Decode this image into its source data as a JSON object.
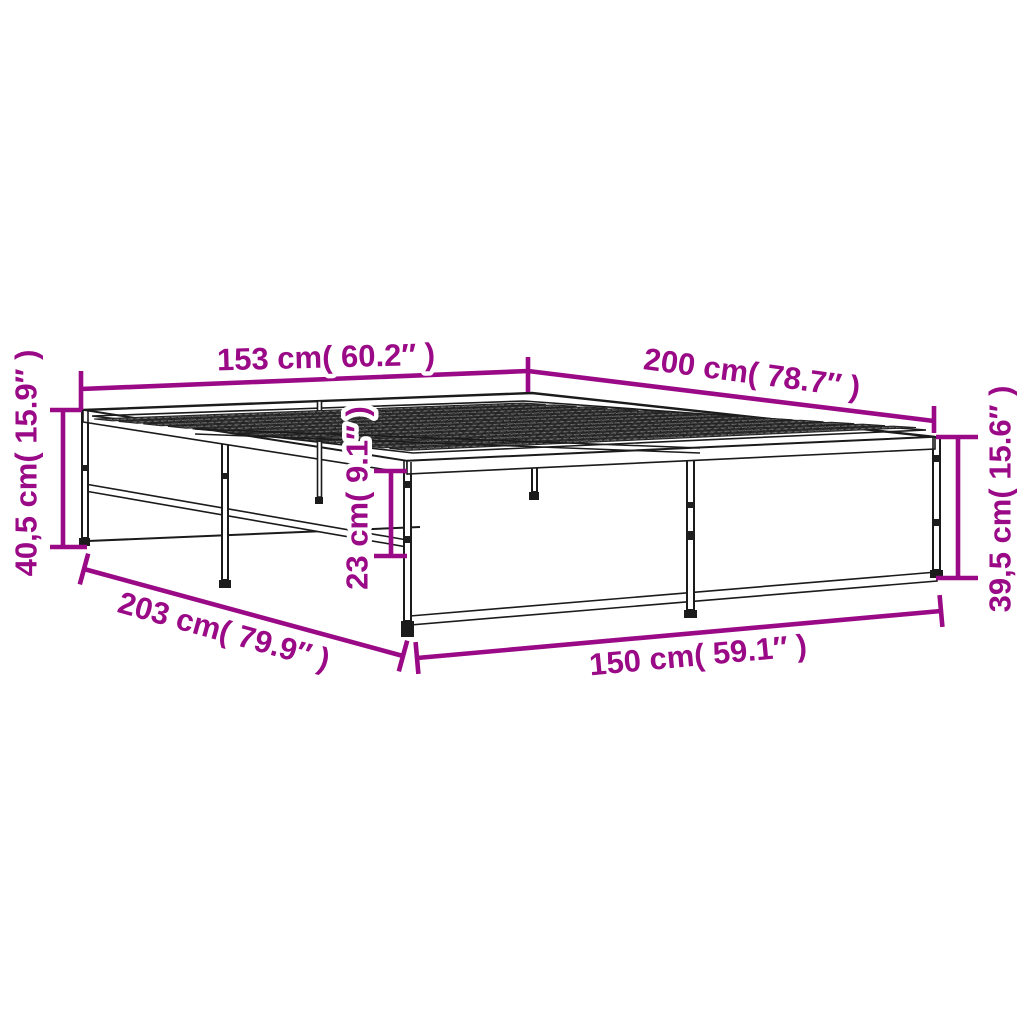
{
  "figure": {
    "type": "product-dimension-diagram",
    "subject_label": "bed frame line drawing"
  },
  "colors": {
    "accent": "#9A0986",
    "line": "#1b1b1b",
    "background": "#ffffff"
  },
  "dimensions": {
    "top_width": {
      "label": "153 cm( 60.2″ )"
    },
    "top_length": {
      "label": "200 cm( 78.7″ )"
    },
    "left_height": {
      "label": "40,5 cm( 15.9″ )"
    },
    "right_height": {
      "label": "39,5 cm( 15.6″ )"
    },
    "inner_height": {
      "label": "23 cm( 9.1″ )"
    },
    "bottom_length": {
      "label": "203 cm( 79.9″ )"
    },
    "bottom_width": {
      "label": "150 cm( 59.1″ )"
    }
  }
}
